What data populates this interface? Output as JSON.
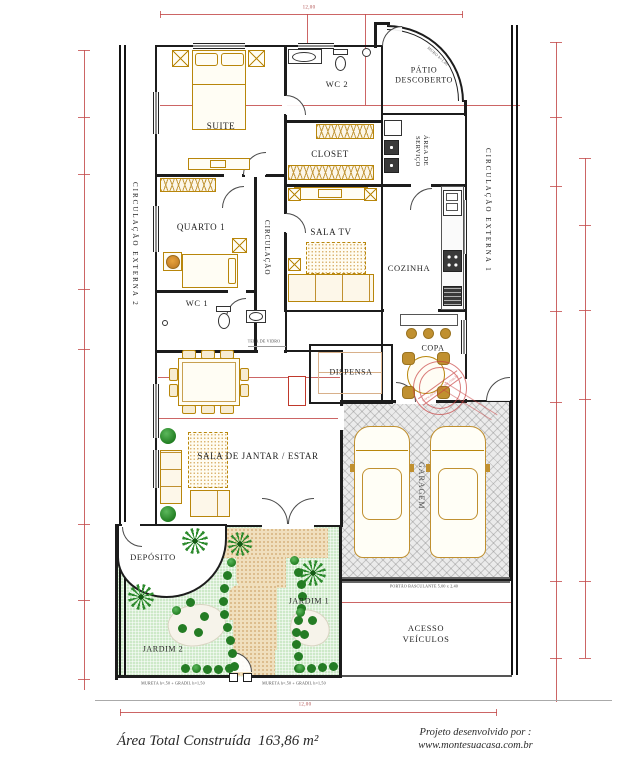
{
  "plan": {
    "rooms": {
      "suite": "SUITE",
      "wc2": "WC 2",
      "patio1": "PÁTIO",
      "patio2": "DESCOBERTO",
      "closet": "CLOSET",
      "area_servico": "ÁREA DE SERVIÇO",
      "quarto1": "QUARTO 1",
      "circulacao": "CIRCULAÇÃO",
      "sala_tv": "SALA TV",
      "cozinha": "COZINHA",
      "wc1": "WC 1",
      "copa": "COPA",
      "dispensa": "DISPENSA",
      "sala_jantar": "SALA DE JANTAR / ESTAR",
      "garagem": "GARAGEM",
      "deposito": "DEPÓSITO",
      "jardim1": "JARDIM 1",
      "jardim2": "JARDIM 2",
      "acesso1": "ACESSO",
      "acesso2": "VEÍCULOS",
      "circ_ext1": "CIRCULAÇÃO EXTERNA 1",
      "circ_ext2": "CIRCULAÇÃO EXTERNA 2"
    },
    "annotations": {
      "muro": "MURO h=1,80",
      "tela_vidro": "TELA DE VIDRO",
      "portao": "PORTÃO BASCULANTE 5,00 x 2,40",
      "mureta_esq": "MURETA h=,50 + GRADIL h=1,50",
      "mureta_dir": "MURETA h=,50 + GRADIL h=1,50",
      "dim_top": "12,00",
      "dim_bottom": "12,00"
    },
    "stamp": {
      "text": "www.montesuacasa.com.br"
    }
  },
  "footer": {
    "area_label": "Área Total Construída",
    "area_value": "163,86 m²",
    "credit1": "Projeto desenvolvido por :",
    "credit2": "www.montesuacasa.com.br"
  },
  "colors": {
    "wall": "#1c1c1c",
    "dimension": "#c34a4a",
    "furniture": "#b8860b",
    "garden": "#cde9c8",
    "plants": "#2e8b2e",
    "path_sand": "#f0dfbd",
    "garage_floor": "#ebebeb",
    "stamp_red": "#c84040"
  }
}
